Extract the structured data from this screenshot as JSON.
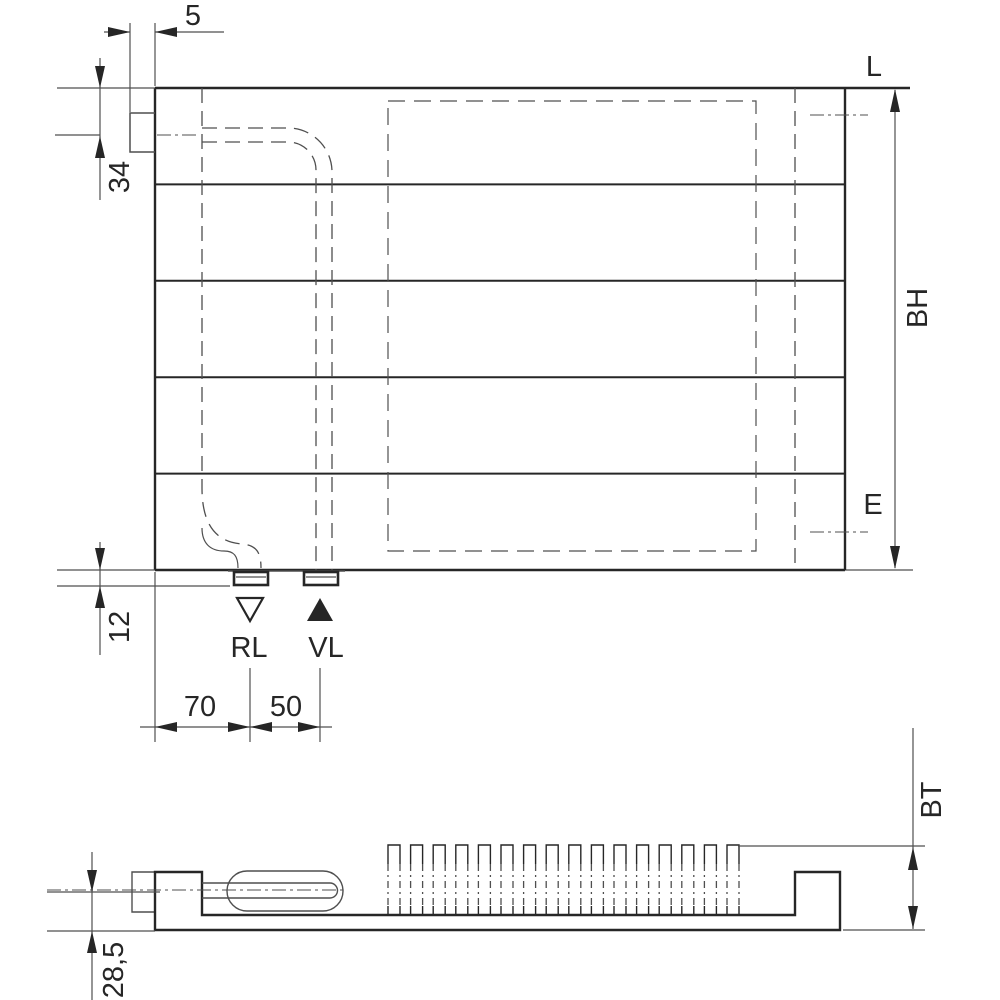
{
  "dimensions": {
    "bracket_offset": "5",
    "top_edge_to_connection_center": "34",
    "bottom_edge_to_stub": "12",
    "left_edge_to_rl": "70",
    "rl_to_vl": "50",
    "center_to_bottom_depth": "28,5"
  },
  "labels": {
    "length": "L",
    "build_height": "BH",
    "hanger_distance": "E",
    "return_line": "RL",
    "supply_line": "VL",
    "build_depth": "BT"
  },
  "icons": {
    "supply_flow": "filled-triangle-up",
    "return_flow": "hollow-triangle-down"
  },
  "colors": {
    "line_dark": "#262626",
    "line_medium": "#4f4f4f",
    "background": "#ffffff"
  },
  "bottom_view": {
    "fin_count": 16
  }
}
